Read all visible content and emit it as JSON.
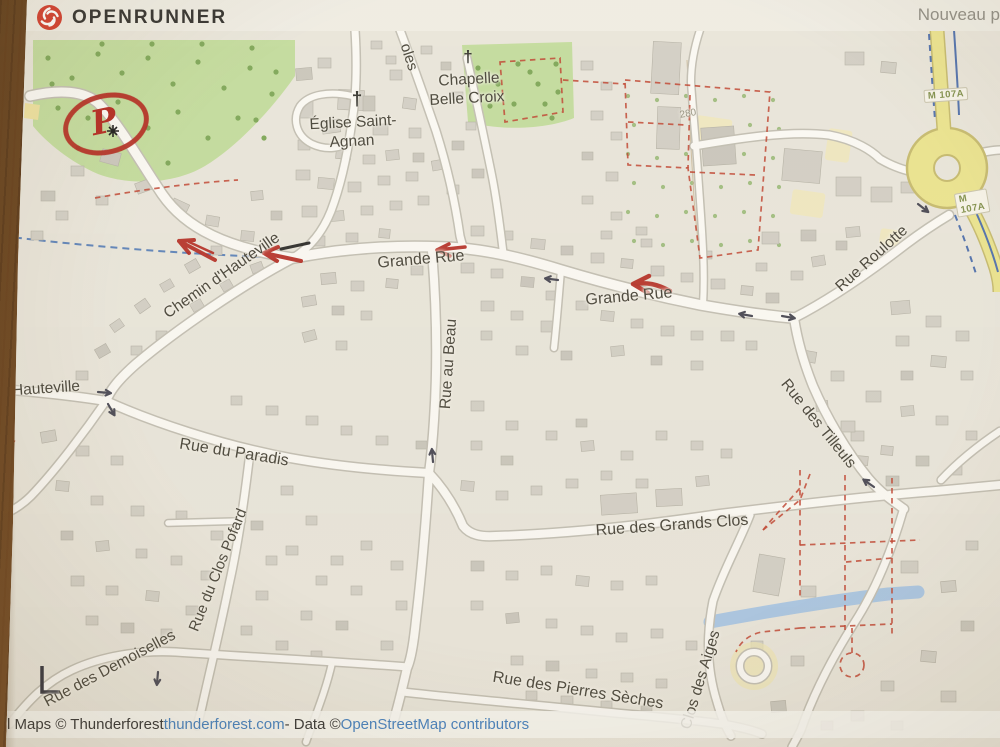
{
  "header": {
    "brand": "OPENRUNNER",
    "page_title_partial": "Nouveau p"
  },
  "map": {
    "labels": {
      "street_partial_oles": "oles",
      "chapelle_line1": "Chapelle",
      "chapelle_line2": "Belle Croix",
      "eglise_line1": "Église Saint-",
      "eglise_line2": "Agnan",
      "elevation_280": "280",
      "grande_rue_west": "Grande Rue",
      "grande_rue_east": "Grande Rue",
      "chemin_hauteville": "Chemin d'Hauteville",
      "hauteville": "Hauteville",
      "rue_au_beau": "Rue au Beau",
      "rue_roulotte": "Rue Roulotte",
      "rue_des_tilleuls": "Rue des Tilleuls",
      "rue_du_paradis": "Rue du Paradis",
      "rue_des_grands_clos": "Rue des Grands Clos",
      "rue_du_clos_pofard": "Rue du Clos Pofard",
      "rue_des_demoiselles": "Rue des Demoiselles",
      "rue_des_pierres_seches": "Rue des Pierres Sèches",
      "clos_des_aiges": "Clos des Aiges"
    },
    "badges": {
      "m107a_north": "M 107A",
      "m107a_south": "M 107A"
    },
    "icons": {
      "brand_logo": "red-swirl-circle",
      "church_cross": "†",
      "chapel_cross": "†"
    }
  },
  "annotations": {
    "parking_letter": "P"
  },
  "attribution": {
    "prefix": "l Maps © Thunderforest ",
    "thunderforest_link": "thunderforest.com",
    "separator": " - Data © ",
    "osm_link": "OpenStreetMap contributors"
  },
  "colors": {
    "annotation_red": "#b3261e",
    "link_blue": "#3f7ec0",
    "road_ref_green": "#7f8f4a",
    "water_blue": "#a9c7e6",
    "green_area": "#c3dd9e",
    "yellow_road": "#ece58f"
  }
}
